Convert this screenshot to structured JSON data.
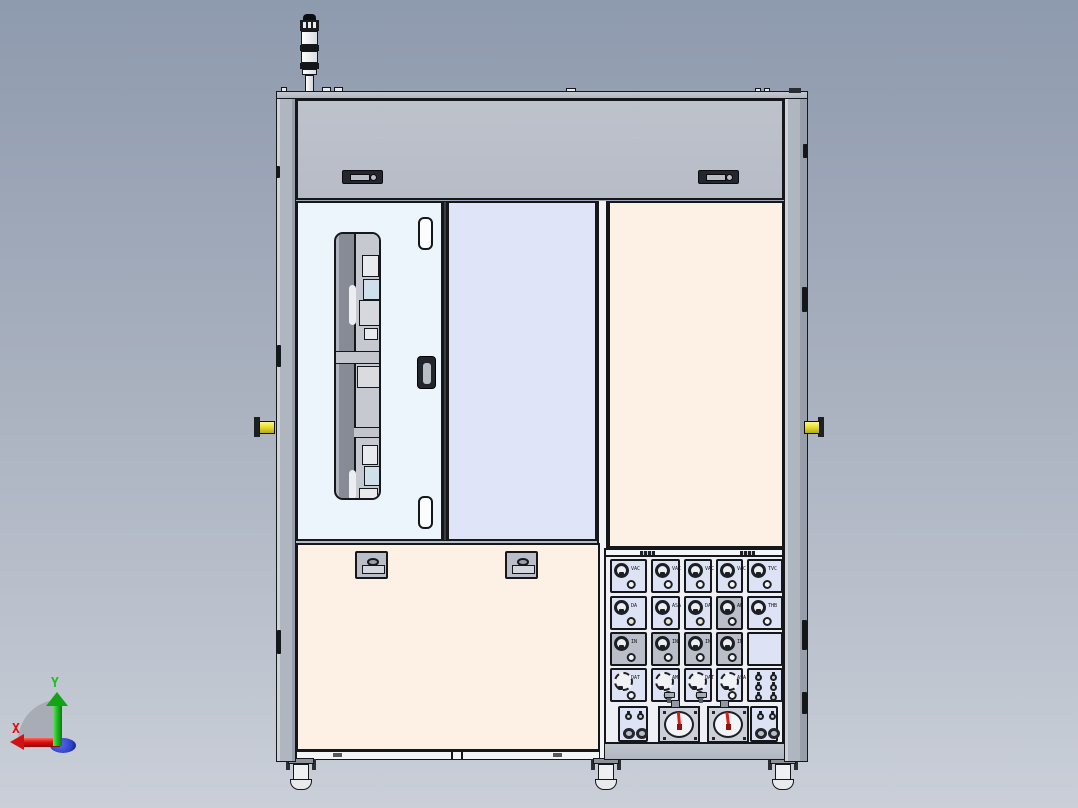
{
  "viewer": {
    "view_name": "machine-front-view",
    "background_top": "#8e9aae",
    "background_bottom": "#cacfd8"
  },
  "axis_triad": {
    "x_label": "X",
    "y_label": "Y",
    "x_color": "#e01010",
    "y_color": "#1fbf22",
    "origin_color": "#3042d0",
    "sector_color": "#a0a5ae"
  },
  "machine": {
    "colors": {
      "outline": "#15171b",
      "frame": "#b0b6c0",
      "top_panel": "#b7bcc6",
      "left_door": "#ecf4fc",
      "middle_door": "#e0e4f8",
      "cream_panel": "#fdf0e5",
      "module": "#dde3f5",
      "module_gray": "#b9bec8",
      "dot_beige": "#e9e3d0",
      "dot_white": "#f4f5f7",
      "handle_yellow": "#efe431",
      "needle_red": "#d42015"
    },
    "signal_tower": {
      "segment_count": 3
    },
    "top_panel": {
      "handle_count": 2
    },
    "left_door": {
      "hinge_count": 2,
      "has_window": true
    },
    "bottom_left_panel": {
      "latch_count": 2
    },
    "feet_count": 3,
    "gauge_panel": {
      "columns": [
        {
          "cells": [
            {
              "kind": "knob",
              "label": "VAC",
              "dot": "white"
            },
            {
              "kind": "knob",
              "label": "DA",
              "dot": "beige"
            },
            {
              "kind": "knob",
              "label": "IN",
              "dot": "white",
              "bg": "gray"
            },
            {
              "kind": "knob_large",
              "label": "DAT",
              "dot": "white"
            }
          ]
        },
        {
          "cells": [
            {
              "kind": "knob",
              "label": "VAC",
              "dot": "white"
            },
            {
              "kind": "knob",
              "label": "ASA",
              "dot": "beige"
            },
            {
              "kind": "knob",
              "label": "IN",
              "dot": "white",
              "bg": "gray"
            },
            {
              "kind": "knob_large",
              "label": "AM",
              "dot": "white",
              "lever": true
            }
          ]
        },
        {
          "cells": [
            {
              "kind": "knob",
              "label": "VAC",
              "dot": "white"
            },
            {
              "kind": "knob",
              "label": "DA",
              "dot": "beige"
            },
            {
              "kind": "knob",
              "label": "IN",
              "dot": "white",
              "bg": "gray"
            },
            {
              "kind": "knob_large",
              "label": "DAT",
              "dot": "white",
              "lever": true
            }
          ]
        },
        {
          "cells": [
            {
              "kind": "knob",
              "label": "VAC",
              "dot": "white"
            },
            {
              "kind": "knob",
              "label": "AB",
              "dot": "white",
              "bg": "gray"
            },
            {
              "kind": "knob",
              "label": "IN",
              "dot": "white",
              "bg": "gray"
            },
            {
              "kind": "knob_large",
              "label": "ASA",
              "dot": "white"
            }
          ]
        },
        {
          "cells": [
            {
              "kind": "knob",
              "label": "TVC",
              "dot": "white"
            },
            {
              "kind": "knob",
              "label": "THB",
              "dot": "white"
            },
            {
              "kind": "blank"
            },
            {
              "kind": "fittings6"
            }
          ]
        }
      ],
      "bottom_row": [
        {
          "type": "fittings"
        },
        {
          "type": "gauge",
          "needle_angle": -5
        },
        {
          "type": "gauge",
          "needle_angle": -7
        },
        {
          "type": "fittings"
        }
      ]
    }
  }
}
